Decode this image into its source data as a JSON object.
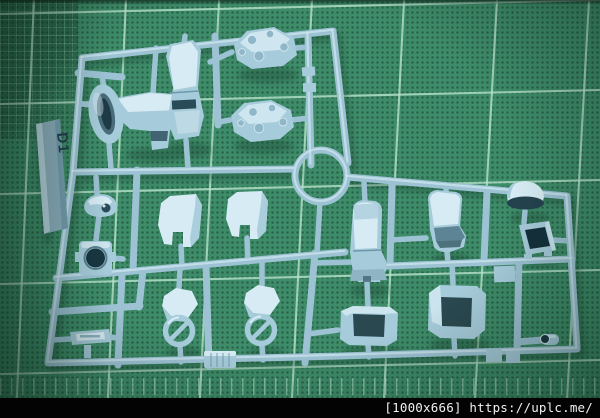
{
  "scene": {
    "description": "Light-blue plastic model kit runner (sprue) with molded mecha parts lying on a green self-healing cutting mat"
  },
  "sprue": {
    "label": "D1"
  },
  "watermark": {
    "text": "[1000x666] https://uplc.me/"
  },
  "colors": {
    "mat-base": "#3e8c69",
    "mat-dark": "#2b6b4f",
    "grid-line": "#b9e4cc",
    "plastic-light": "#d6ebf3",
    "plastic-mid": "#a6cbda",
    "plastic-rail": "#9cc2d3",
    "plastic-dark": "#6e98a9",
    "plastic-deep": "#294a57",
    "dome-band": "#24424e",
    "box-interior": "#14303b",
    "tag-bar": "#8badbc",
    "tag-text": "#223f4e",
    "caption-bg": "#030303",
    "caption-text": "#f2f2f2",
    "shadow-green": "#15382a"
  }
}
